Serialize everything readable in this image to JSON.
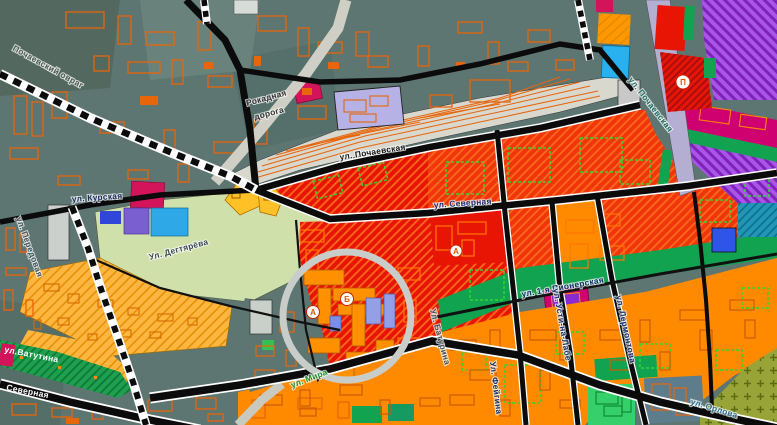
{
  "map": {
    "street_labels": {
      "pochaevsky_ovrag": "Почаевский овраг",
      "rokadnaya_1": "Рокадная",
      "rokadnaya_2": "дорога",
      "pochaevskaya": "ул. Почаевская",
      "pochaevskaya_ne": "ул. Почаевская",
      "severnaya": "ул. Северная",
      "kurskaya": "ул. Курская",
      "degtyaryova": "Ул. Дегтярёва",
      "peredovaya": "ул. Передовая",
      "baturina": "Ул. Батурина",
      "vatutina": "ул.Ватутина",
      "severnaya_sw": "Северная",
      "mira": "ул. Мира",
      "pionerskaya": "ул. 1-я Пионерская",
      "usti_na_labe": "ул. Усти-на-Лабе",
      "lermontova": "ул. Лермонтова",
      "feigina": "Ул. Фейгина",
      "orlova": "ул. Орлова"
    },
    "markers": [
      {
        "letter": "А"
      },
      {
        "letter": "Б"
      },
      {
        "letter": "П"
      },
      {
        "letter": "А"
      }
    ],
    "colors": {
      "slate": "#5e7672",
      "pale_green": "#cfe0aa",
      "amber": "#ffb640",
      "rail_gray": "#d8d8cf",
      "red": "#f1350c",
      "red_dark": "#e81505",
      "orange": "#ff8a00",
      "green": "#12a351",
      "park_green": "#1fa050",
      "purple": "#a855e8",
      "magenta": "#cf0070",
      "crimson": "#d4145a",
      "lavender": "#b3aed2",
      "cyan": "#29b0ee",
      "olive": "#98a437",
      "blue": "#2f55e8",
      "teal": "#2196b8",
      "teal_gray": "#5e7d8c",
      "highlight_ring": "#c9cdc9",
      "road_black": "#0b0b0b",
      "road_white": "#ffffff"
    }
  }
}
